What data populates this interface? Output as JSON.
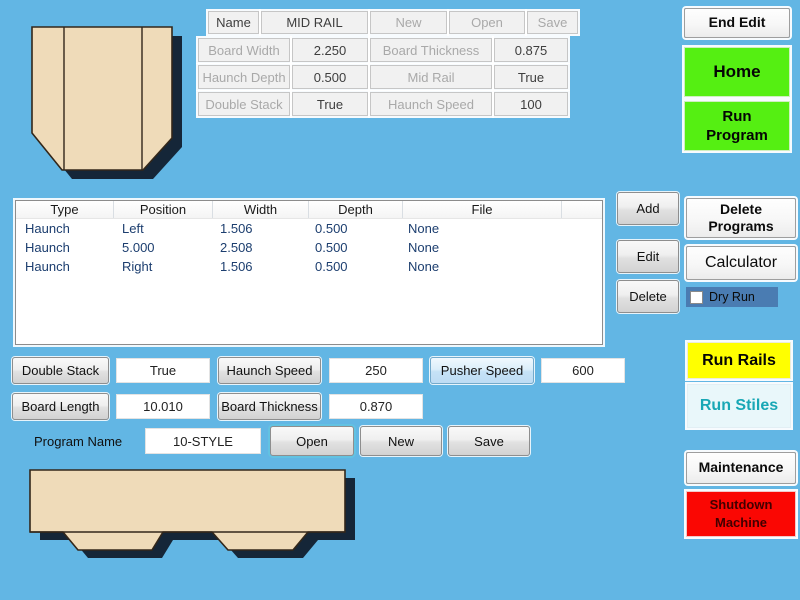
{
  "colors": {
    "background": "#62B6E4",
    "green_button": "#55EF12",
    "yellow_button": "#FFFF00",
    "red_button": "#FA0703",
    "run_stiles_text": "#18A7B5",
    "dry_run_bar": "#4A7CB2",
    "wood_fill": "#EFDBB9",
    "table_row_text": "#1C3E6F"
  },
  "profile_grid": {
    "name_label": "Name",
    "name_value": "MID RAIL",
    "buttons": [
      "New",
      "Open",
      "Save"
    ],
    "fields": [
      {
        "label": "Board Width",
        "value": "2.250"
      },
      {
        "label": "Board Thickness",
        "value": "0.875"
      },
      {
        "label": "Haunch Depth",
        "value": "0.500"
      },
      {
        "label": "Mid Rail",
        "value": "True"
      },
      {
        "label": "Double Stack",
        "value": "True"
      },
      {
        "label": "Haunch Speed",
        "value": "100"
      }
    ]
  },
  "cuts_table": {
    "columns": [
      "Type",
      "Position",
      "Width",
      "Depth",
      "File"
    ],
    "rows": [
      [
        "Haunch",
        "Left",
        "1.506",
        "0.500",
        "None"
      ],
      [
        "Haunch",
        "5.000",
        "2.508",
        "0.500",
        "None"
      ],
      [
        "Haunch",
        "Right",
        "1.506",
        "0.500",
        "None"
      ]
    ]
  },
  "actions": [
    "Add",
    "Edit",
    "Delete"
  ],
  "right_panel": {
    "end_edit": "End Edit",
    "home": "Home",
    "run_program": "Run Program",
    "delete_programs": "Delete Programs",
    "calculator": "Calculator",
    "dry_run": "Dry Run",
    "run_rails": "Run Rails",
    "run_stiles": "Run Stiles",
    "maintenance": "Maintenance",
    "shutdown": "Shutdown Machine"
  },
  "controls": {
    "row1": [
      {
        "label": "Double Stack",
        "value": "True"
      },
      {
        "label": "Haunch Speed",
        "value": "250"
      },
      {
        "label": "Pusher Speed",
        "value": "600"
      }
    ],
    "row2": [
      {
        "label": "Board Length",
        "value": "10.010"
      },
      {
        "label": "Board Thickness",
        "value": "0.870"
      }
    ],
    "program": {
      "label": "Program Name",
      "value": "10-STYLE",
      "buttons": [
        "Open",
        "New",
        "Save"
      ]
    }
  }
}
